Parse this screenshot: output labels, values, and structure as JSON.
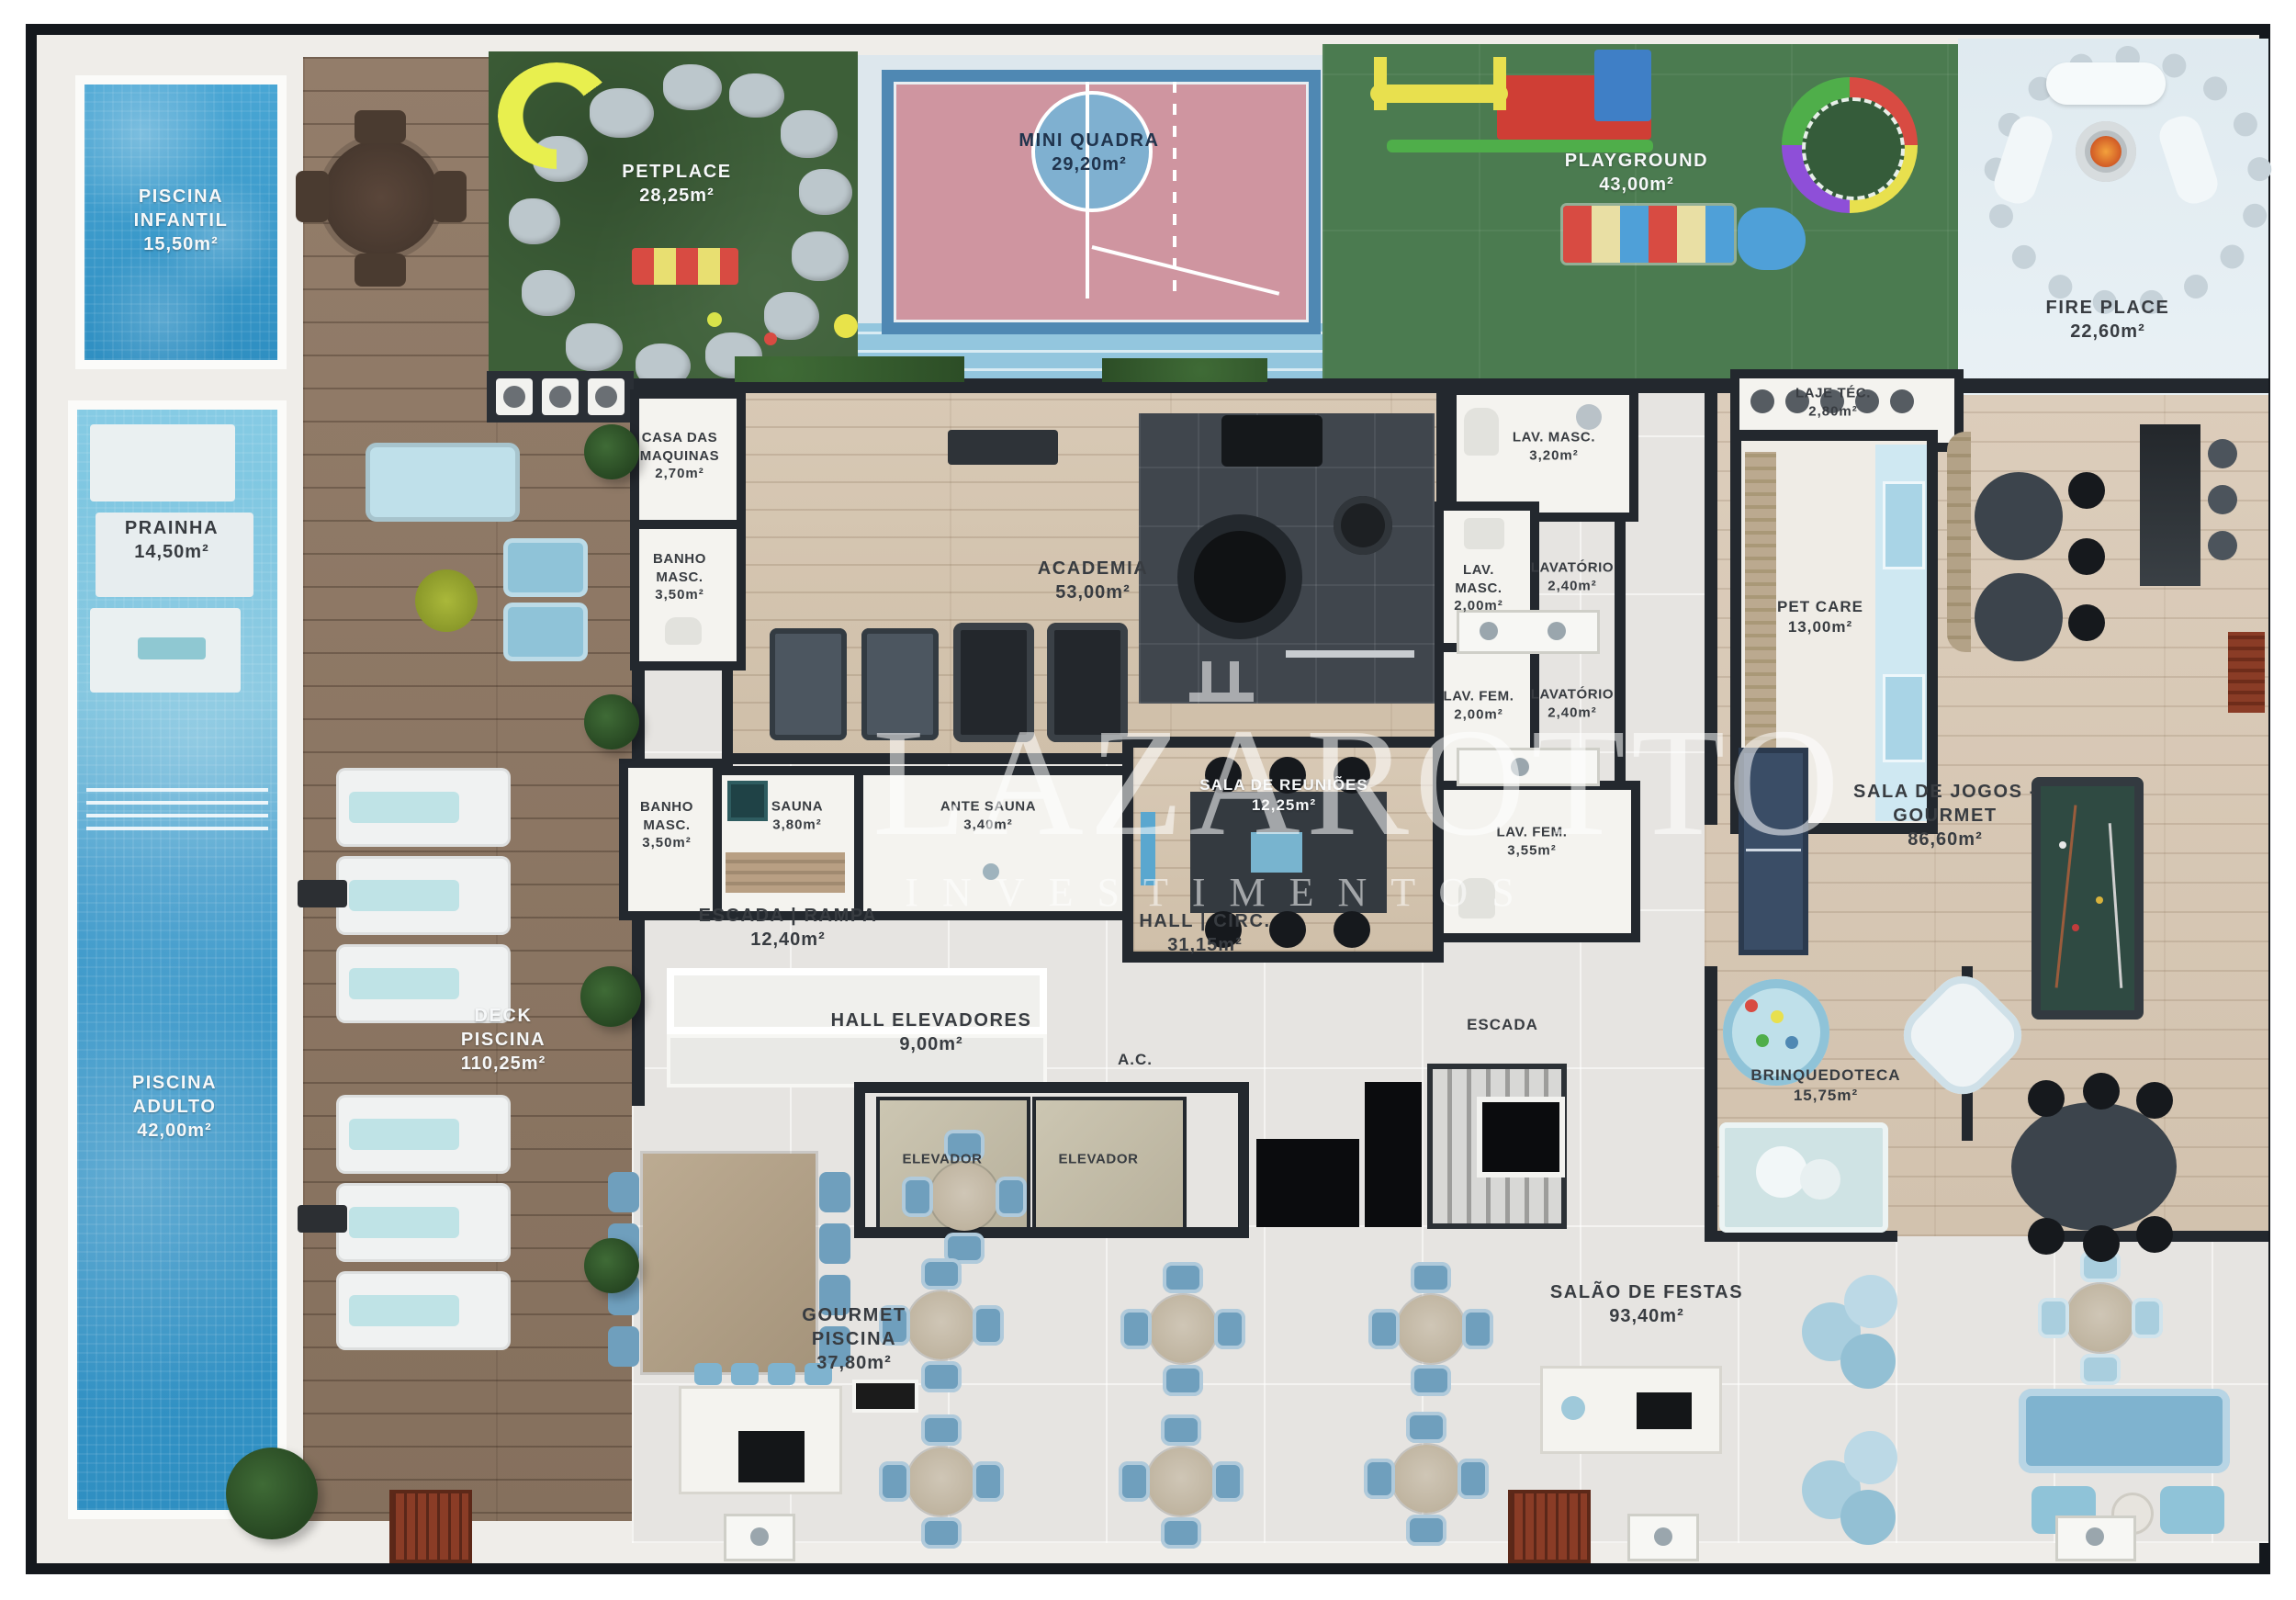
{
  "watermark": {
    "line1": "LAZAROTTO",
    "line2": "INVESTIMENTOS"
  },
  "labels": {
    "elevador": "ELEVADOR",
    "ac": "A.C.",
    "escada": "ESCADA"
  },
  "areas": {
    "piscina_infantil": {
      "name": "PISCINA INFANTIL",
      "area": "15,50m²"
    },
    "prainha": {
      "name": "PRAINHA",
      "area": "14,50m²"
    },
    "piscina_adulto": {
      "name": "PISCINA ADULTO",
      "area": "42,00m²"
    },
    "deck_piscina": {
      "name": "DECK PISCINA",
      "area": "110,25m²"
    },
    "petplace": {
      "name": "PETPLACE",
      "area": "28,25m²"
    },
    "mini_quadra": {
      "name": "MINI QUADRA",
      "area": "29,20m²"
    },
    "playground": {
      "name": "PLAYGROUND",
      "area": "43,00m²"
    },
    "fire_place": {
      "name": "FIRE PLACE",
      "area": "22,60m²"
    },
    "casa_maquinas": {
      "name": "CASA DAS MAQUINAS",
      "area": "2,70m²"
    },
    "banho_masc_1": {
      "name": "BANHO MASC.",
      "area": "3,50m²"
    },
    "banho_masc_2": {
      "name": "BANHO MASC.",
      "area": "3,50m²"
    },
    "academia": {
      "name": "ACADEMIA",
      "area": "53,00m²"
    },
    "sauna": {
      "name": "SAUNA",
      "area": "3,80m²"
    },
    "ante_sauna": {
      "name": "ANTE SAUNA",
      "area": "3,40m²"
    },
    "sala_reunioes": {
      "name": "SALA DE REUNIÕES",
      "area": "12,25m²"
    },
    "lav_masc_320": {
      "name": "LAV. MASC.",
      "area": "3,20m²"
    },
    "lav_masc_200": {
      "name": "LAV. MASC.",
      "area": "2,00m²"
    },
    "lavatorio_1": {
      "name": "LAVATÓRIO",
      "area": "2,40m²"
    },
    "lav_fem_200": {
      "name": "LAV. FEM.",
      "area": "2,00m²"
    },
    "lavatorio_2": {
      "name": "LAVATÓRIO",
      "area": "2,40m²"
    },
    "lav_fem_355": {
      "name": "LAV. FEM.",
      "area": "3,55m²"
    },
    "laje_tec": {
      "name": "LAJE TÉC.",
      "area": "2,80m²"
    },
    "pet_care": {
      "name": "PET CARE",
      "area": "13,00m²"
    },
    "sala_jogos": {
      "name": "SALA DE JOGOS - GOURMET",
      "area": "86,60m²"
    },
    "escada_rampa": {
      "name": "ESCADA | RAMPA",
      "area": "12,40m²"
    },
    "hall_circ": {
      "name": "HALL | CIRC.",
      "area": "31,15m²"
    },
    "hall_elevadores": {
      "name": "HALL ELEVADORES",
      "area": "9,00m²"
    },
    "brinquedoteca": {
      "name": "BRINQUEDOTECA",
      "area": "15,75m²"
    },
    "gourmet_piscina": {
      "name": "GOURMET PISCINA",
      "area": "37,80m²"
    },
    "salao_festas": {
      "name": "SALÃO DE FESTAS",
      "area": "93,40m²"
    }
  }
}
